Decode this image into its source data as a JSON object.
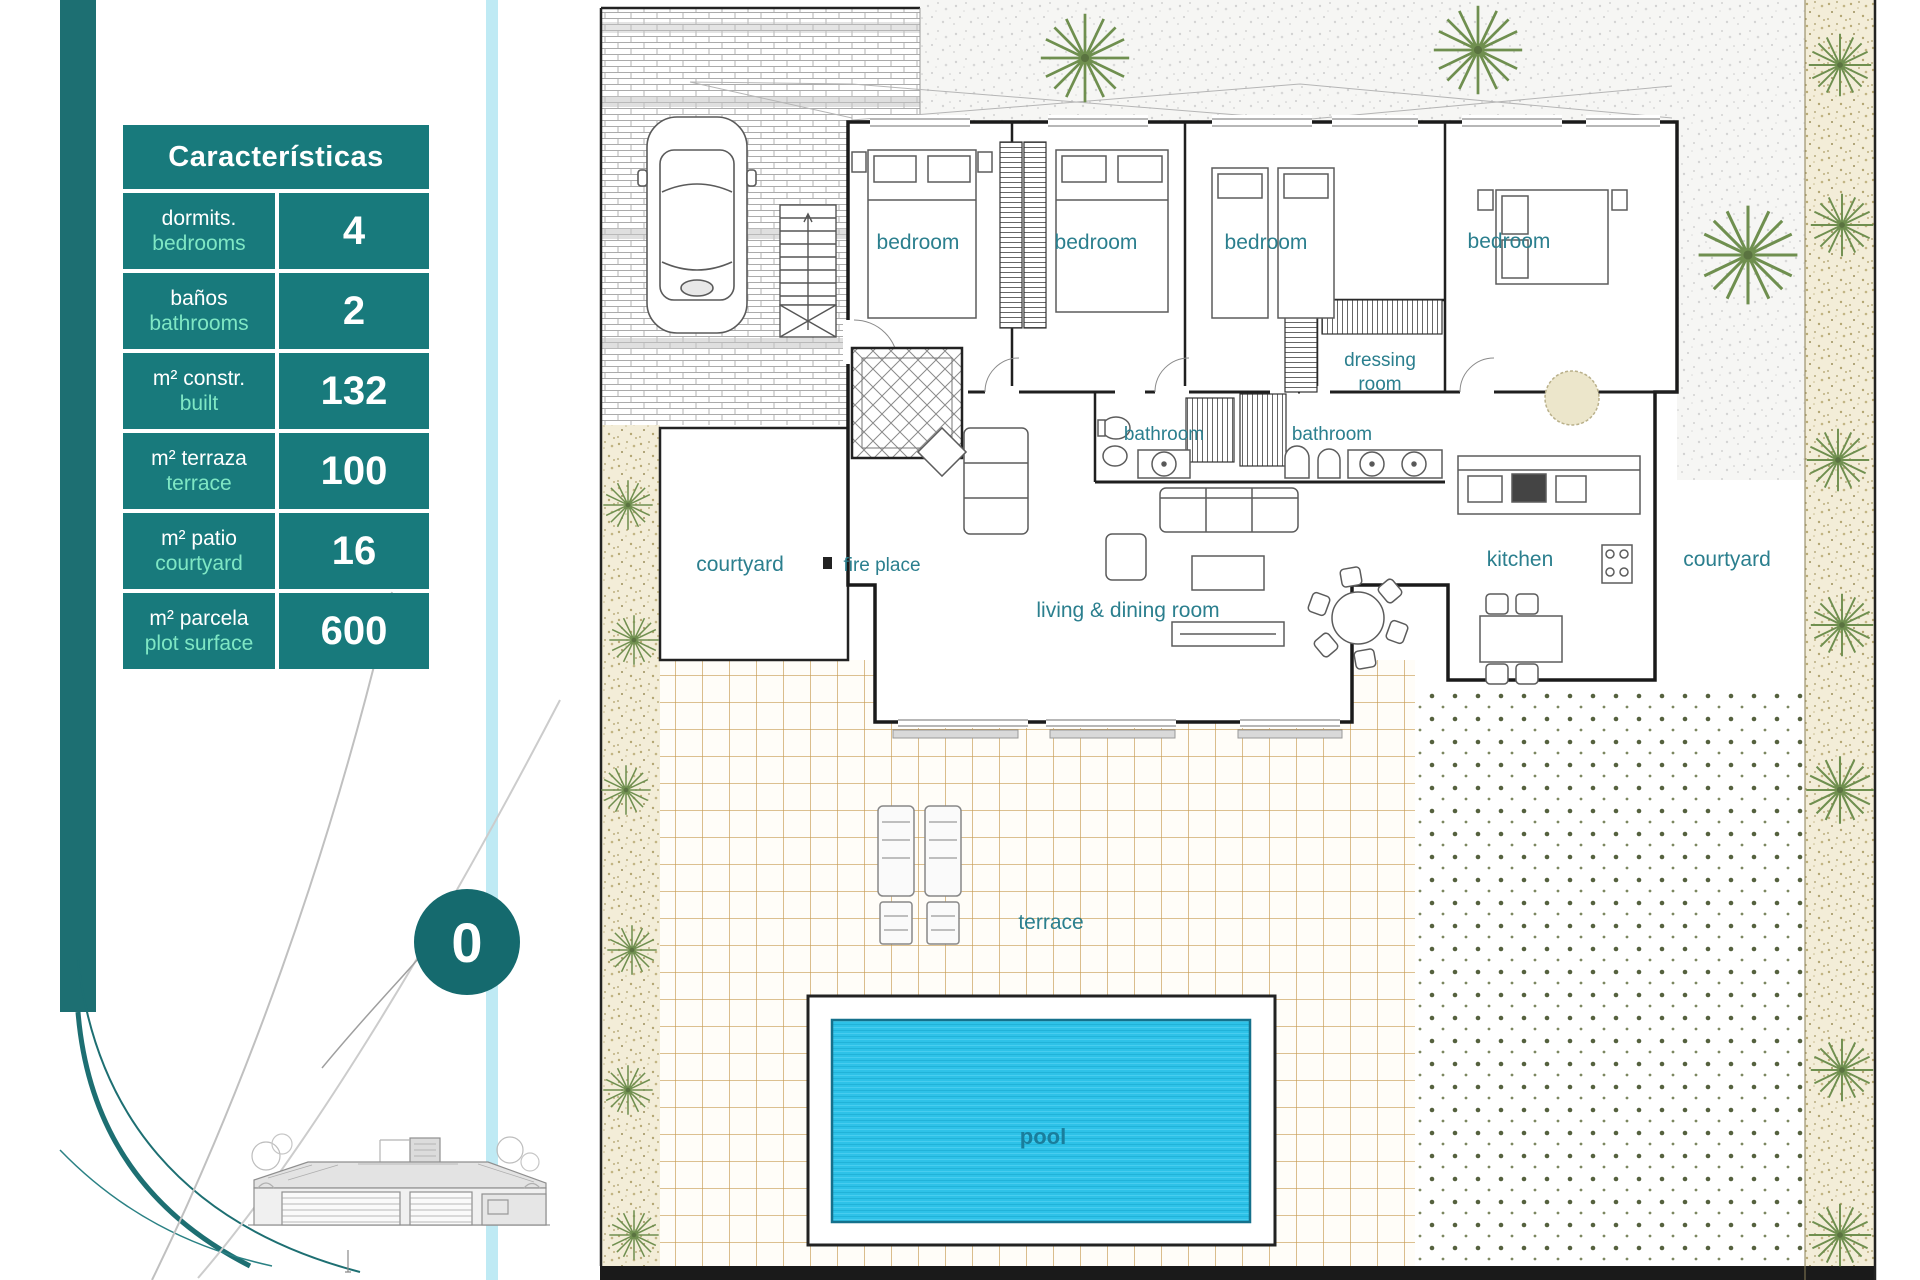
{
  "characteristics_table": {
    "title": "Características",
    "rows": [
      {
        "label_es": "dormits.",
        "label_en": "bedrooms",
        "value": "4"
      },
      {
        "label_es": "baños",
        "label_en": "bathrooms",
        "value": "2"
      },
      {
        "label_es": "m² constr.",
        "label_en": "built",
        "value": "132"
      },
      {
        "label_es": "m² terraza",
        "label_en": "terrace",
        "value": "100"
      },
      {
        "label_es": "m² patio",
        "label_en": "courtyard",
        "value": "16"
      },
      {
        "label_es": "m² parcela",
        "label_en": "plot surface",
        "value": "600"
      }
    ]
  },
  "floor_badge": {
    "value": "0"
  },
  "plan_labels": {
    "bedroom": "bedroom",
    "bathroom": "bathroom",
    "dressing_line1": "dressing",
    "dressing_line2": "room",
    "courtyard": "courtyard",
    "fire_place": "fire place",
    "living_dining": "living & dining room",
    "kitchen": "kitchen",
    "terrace": "terrace",
    "pool": "pool"
  },
  "colors": {
    "table_teal": "#187a7c",
    "mint_green": "#7fe7c4",
    "sidebar_teal": "#1d6f72",
    "badge_teal": "#156a6e",
    "room_label_teal": "#2b7f8e",
    "pool_water": "#2ec2e8",
    "pool_border": "#15718c",
    "terrace_grid_line": "#c79b52"
  }
}
